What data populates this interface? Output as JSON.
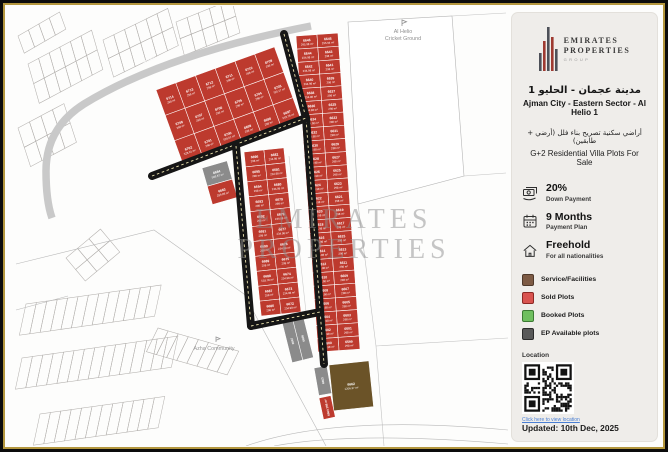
{
  "sidebar": {
    "logo": {
      "line1": "EMIRATES",
      "line2": "PROPERTIES",
      "line3": "GROUP"
    },
    "title_ar": "مدينة عجمان - الحليو 1",
    "title_en": "Ajman City - Eastern Sector - Al Helio 1",
    "subtitle_ar": "أراضي سكنية تصريح بناء فلل (أرضي + طابقين)",
    "subtitle_en": "G+2 Residential Villa Plots For Sale",
    "features": [
      {
        "icon": "cash-icon",
        "value": "20%",
        "label": "Down Payment"
      },
      {
        "icon": "calendar-icon",
        "value": "9 Months",
        "label": "Payment Plan"
      },
      {
        "icon": "freehold-icon",
        "value": "Freehold",
        "label": "For all nationalities"
      }
    ],
    "legend": [
      {
        "color": "#7d5a44",
        "border": "#4e382a",
        "label": "Service/Facilities"
      },
      {
        "color": "#d9534f",
        "border": "#8c2824",
        "label": "Sold Plots"
      },
      {
        "color": "#6fbf5f",
        "border": "#3c7a33",
        "label": "Booked Plots"
      },
      {
        "color": "#595959",
        "border": "#2b2b2b",
        "label": "EP Available plots"
      }
    ],
    "location_label": "Location",
    "qr_link_text": "Click here to view location",
    "updated": "Updated:  10th Dec, 2025"
  },
  "map": {
    "road_label": "Road",
    "cricket_ground_label_1": "Al Helio",
    "cricket_ground_label_2": "Cricket Ground",
    "community_label": "Azha Community",
    "watermark_1": "EMIRATES",
    "watermark_2": "PROPERTIES",
    "colors": {
      "sold": "#bd3a2e",
      "available": "#8b8b8b",
      "service": "#6b5328",
      "road": "#161616"
    },
    "blocks": [
      {
        "name": "fan-block",
        "x": 150,
        "y": 84,
        "rot": -20,
        "rows": 3,
        "cols": 6,
        "cw": 21,
        "ch": 27,
        "type": "sold",
        "plots": [
          [
            "6714",
            "298 m²"
          ],
          [
            "6713",
            "298 m²"
          ],
          [
            "6712",
            "298 m²"
          ],
          [
            "6711",
            "298 m²"
          ],
          [
            "6710",
            "298 m²"
          ],
          [
            "6709",
            "298 m²"
          ],
          [
            "6708",
            "298 m²"
          ],
          [
            "6707",
            "298 m²"
          ],
          [
            "6706",
            "298 m²"
          ],
          [
            "6705",
            "298 m²"
          ],
          [
            "6704",
            "298 m²"
          ],
          [
            "6703",
            "795.17 m²"
          ],
          [
            "6702",
            "528.01 m²"
          ],
          [
            "6701",
            "298 m²"
          ],
          [
            "6700",
            "528.01 m²"
          ],
          [
            "6699",
            "298 m²"
          ],
          [
            "6698",
            "298 m²"
          ],
          [
            "6697",
            "518.78 m²"
          ]
        ]
      },
      {
        "name": "upper-pair",
        "x": 196,
        "y": 162,
        "rot": -16,
        "rows": 2,
        "cols": 1,
        "cw": 26,
        "ch": 19,
        "type": "sold",
        "plots": [
          [
            "6684",
            "598.87 m²",
            "available"
          ],
          [
            "6683",
            "299.88 m²",
            "sold"
          ]
        ]
      },
      {
        "name": "strip-left",
        "x": 238,
        "y": 146,
        "rot": -6,
        "rows": 11,
        "cols": 2,
        "cw": 20,
        "ch": 15,
        "type": "sold",
        "plots": [
          [
            "6696",
            "298 m²"
          ],
          [
            "6682",
            "234.98 m²"
          ],
          [
            "6695",
            "298 m²"
          ],
          [
            "6681",
            "234.98 m²"
          ],
          [
            "6694",
            "298 m²"
          ],
          [
            "6680",
            "234.98 m²"
          ],
          [
            "6693",
            "298 m²"
          ],
          [
            "6679",
            "298 m²"
          ],
          [
            "6692",
            "298 m²"
          ],
          [
            "6678",
            "234.98 m²"
          ],
          [
            "6691",
            "298 m²"
          ],
          [
            "6677",
            "234.98 m²"
          ],
          [
            "6690",
            "298 m²"
          ],
          [
            "6676",
            "234.98 m²"
          ],
          [
            "6689",
            "298 m²"
          ],
          [
            "6675",
            "298 m²"
          ],
          [
            "6688",
            "518.78 m²"
          ],
          [
            "6674",
            "234.98 m²"
          ],
          [
            "6687",
            "298 m²"
          ],
          [
            "6673",
            "234.98 m²"
          ],
          [
            "6686",
            "298 m²"
          ],
          [
            "6672",
            "234.98 m²"
          ]
        ]
      },
      {
        "name": "strip-right",
        "x": 290,
        "y": 30,
        "rot": -4,
        "rows": 24,
        "cols": 2,
        "cw": 21,
        "ch": 13.2,
        "type": "sold",
        "plots": [
          [
            "6646",
            "295.98 m²"
          ],
          [
            "6645",
            "295.94 m²"
          ],
          [
            "6644",
            "234.98 m²"
          ],
          [
            "6643",
            "298 m²"
          ],
          [
            "6642",
            "234.98 m²"
          ],
          [
            "6641",
            "298 m²"
          ],
          [
            "6640",
            "234.98 m²"
          ],
          [
            "6639",
            "298 m²"
          ],
          [
            "6638",
            "234.98 m²"
          ],
          [
            "6637",
            "298 m²"
          ],
          [
            "6636",
            "234.98 m²"
          ],
          [
            "6635",
            "298 m²"
          ],
          [
            "6634",
            "234.98 m²"
          ],
          [
            "6633",
            "298 m²"
          ],
          [
            "6632",
            "234.98 m²"
          ],
          [
            "6631",
            "298 m²"
          ],
          [
            "6630",
            "234.98 m²"
          ],
          [
            "6629",
            "298 m²"
          ],
          [
            "6628",
            "234.98 m²"
          ],
          [
            "6627",
            "298 m²"
          ],
          [
            "6626",
            "234.98 m²"
          ],
          [
            "6625",
            "298 m²"
          ],
          [
            "6624",
            "234.98 m²"
          ],
          [
            "6623",
            "298 m²"
          ],
          [
            "6622",
            "234.98 m²"
          ],
          [
            "6621",
            "298 m²"
          ],
          [
            "6620",
            "234.98 m²"
          ],
          [
            "6619",
            "298 m²"
          ],
          [
            "6618",
            "234.98 m²"
          ],
          [
            "6617",
            "298 m²"
          ],
          [
            "6616",
            "234.98 m²"
          ],
          [
            "6615",
            "298 m²"
          ],
          [
            "6614",
            "234.98 m²"
          ],
          [
            "6613",
            "298 m²"
          ],
          [
            "6612",
            "234.98 m²"
          ],
          [
            "6611",
            "298 m²"
          ],
          [
            "6610",
            "234.98 m²"
          ],
          [
            "6609",
            "298 m²"
          ],
          [
            "6608",
            "234.98 m²"
          ],
          [
            "6607",
            "298 m²"
          ],
          [
            "6606",
            "234.98 m²"
          ],
          [
            "6605",
            "298 m²"
          ],
          [
            "6604",
            "234.98 m²"
          ],
          [
            "6603",
            "298 m²"
          ],
          [
            "6602",
            "234.98 m²"
          ],
          [
            "6601",
            "298 m²"
          ],
          [
            "6600",
            "234.98 m²"
          ],
          [
            "6599",
            "298 m²"
          ]
        ]
      },
      {
        "name": "gray-pair",
        "x": 276,
        "y": 316,
        "rot": -14,
        "rows": 1,
        "cols": 2,
        "cw": 11,
        "ch": 42,
        "vertical": true,
        "type": "available",
        "plots": [
          [
            "6667",
            ""
          ],
          [
            "6666",
            ""
          ]
        ]
      },
      {
        "name": "bottom-gray",
        "x": 308,
        "y": 362,
        "rot": -10,
        "rows": 1,
        "cols": 1,
        "cw": 13,
        "ch": 28,
        "vertical": true,
        "type": "available",
        "plots": [
          [
            "6663",
            ""
          ]
        ]
      },
      {
        "name": "service-plot",
        "x": 323,
        "y": 359,
        "rot": -6,
        "rows": 1,
        "cols": 1,
        "cw": 40,
        "ch": 46,
        "type": "service",
        "plots": [
          [
            "6662",
            "1206.37 m²"
          ]
        ]
      },
      {
        "name": "bottom-red",
        "x": 313,
        "y": 392,
        "rot": -12,
        "rows": 1,
        "cols": 1,
        "cw": 12,
        "ch": 22,
        "vertical": true,
        "type": "sold",
        "plots": [
          [
            "6664",
            "298 m²"
          ]
        ]
      }
    ]
  }
}
